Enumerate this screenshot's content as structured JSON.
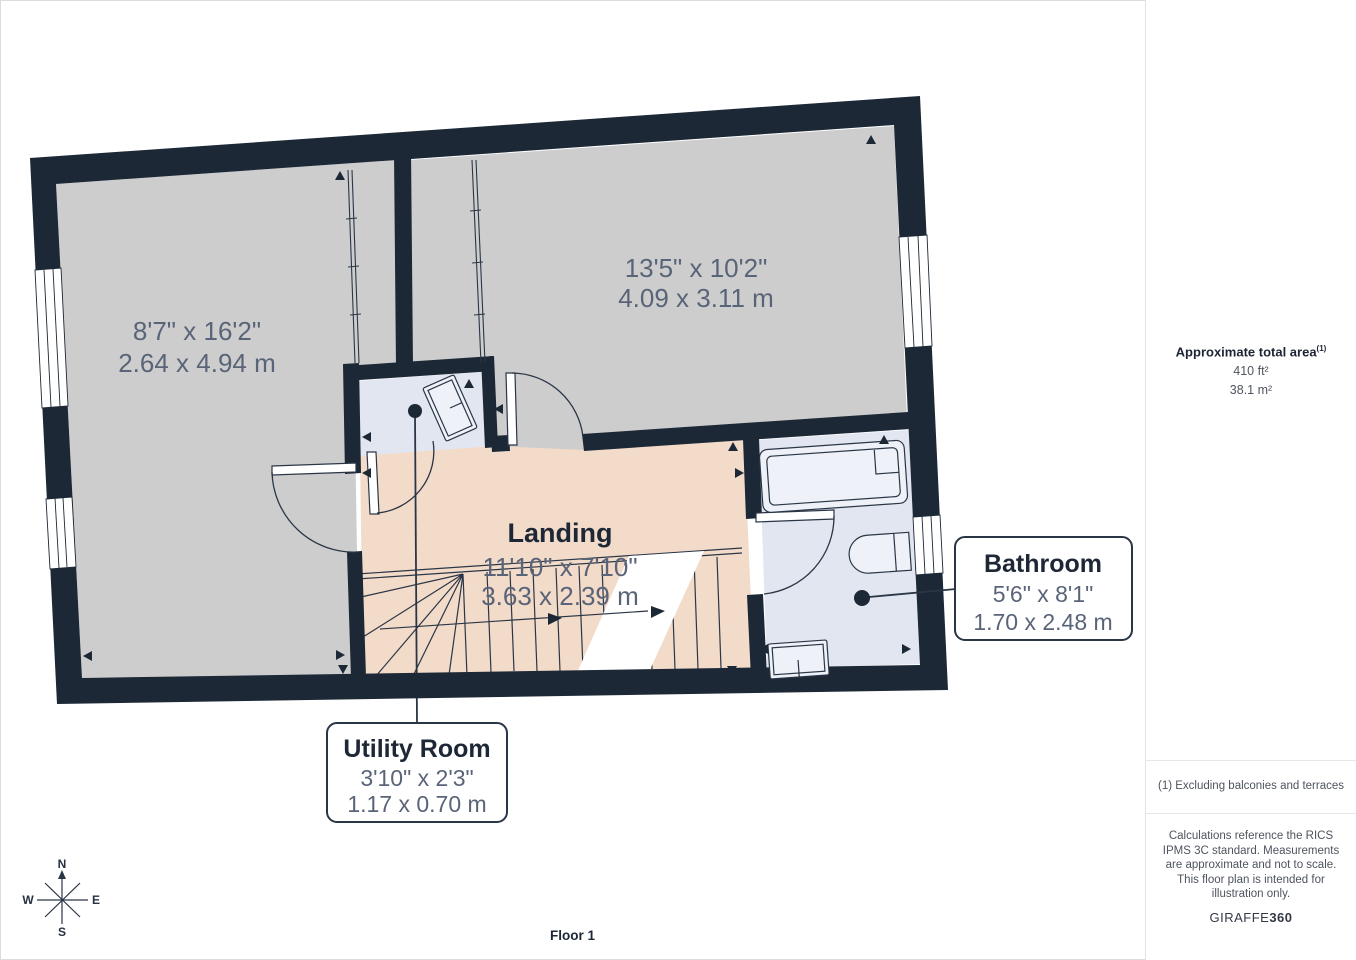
{
  "floor_label": "Floor 1",
  "compass": {
    "n": "N",
    "e": "E",
    "s": "S",
    "w": "W"
  },
  "rooms": {
    "left": {
      "imperial": "8'7\" x 16'2\"",
      "metric": "2.64 x 4.94 m"
    },
    "top_right": {
      "imperial": "13'5\" x 10'2\"",
      "metric": "4.09 x 3.11 m"
    },
    "landing": {
      "name": "Landing",
      "imperial": "11'10\" x 7'10\"",
      "metric": "3.63 x 2.39 m"
    }
  },
  "callouts": {
    "utility": {
      "name": "Utility Room",
      "imperial": "3'10\" x 2'3\"",
      "metric": "1.17 x 0.70 m"
    },
    "bathroom": {
      "name": "Bathroom",
      "imperial": "5'6\" x 8'1\"",
      "metric": "1.70 x 2.48 m"
    }
  },
  "sidebar": {
    "area_title": "Approximate total area",
    "area_sup": "(1)",
    "area_ft": "410 ft²",
    "area_m": "38.1 m²",
    "footnote": "(1) Excluding balconies and terraces",
    "disclaimer": "Calculations reference the RICS IPMS 3C standard. Measurements are approximate and not to scale. This floor plan is intended for illustration only.",
    "brand": "GIRAFFE",
    "brand_bold": "360"
  },
  "colors": {
    "wall": "#1c2836",
    "room_gray": "#cdcdcd",
    "landing_pink": "#f3dbca",
    "wet_room_blue": "#e2e6f0",
    "fixture_fill": "#eef1f7",
    "dim_text": "#5a6478",
    "dark_text": "#1d2736"
  }
}
